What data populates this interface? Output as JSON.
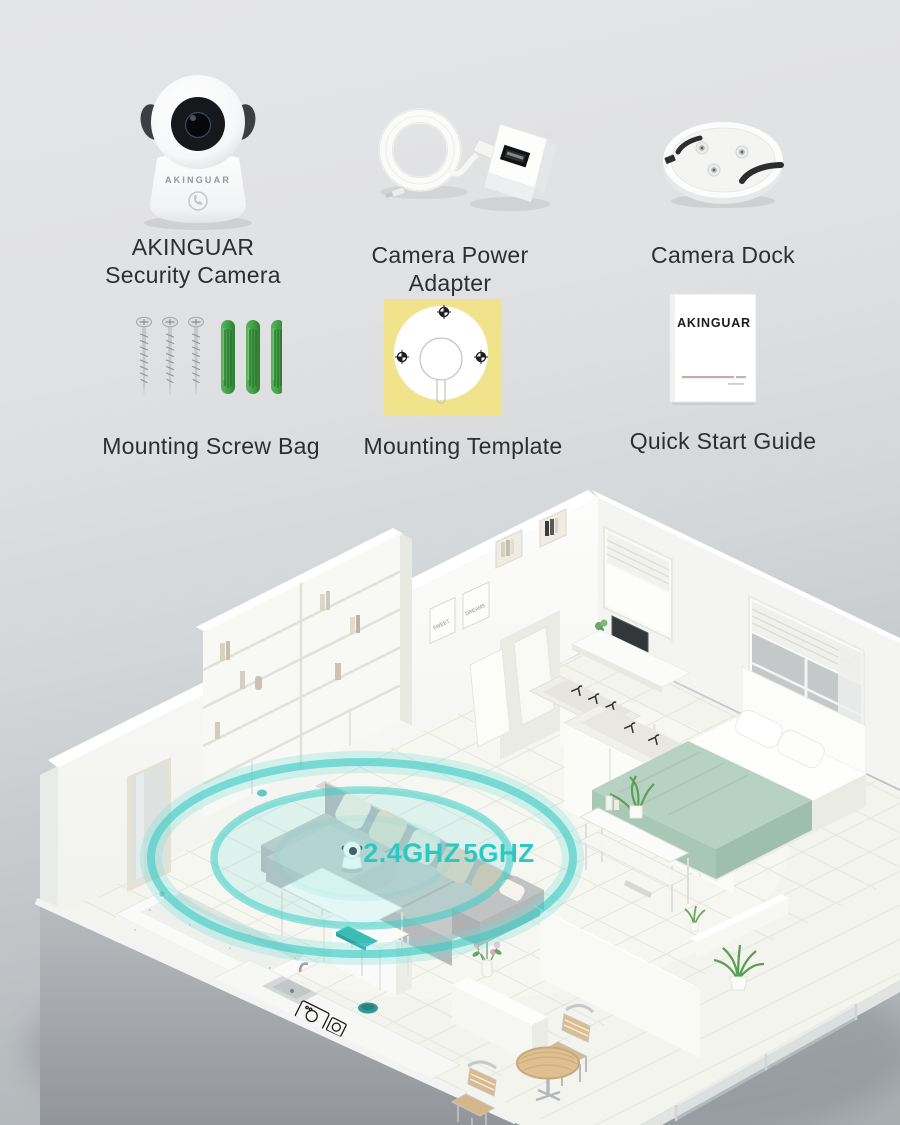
{
  "items": [
    {
      "name": "security-camera",
      "line1": "AKINGUAR",
      "line2": "Security Camera",
      "brand": "AKINGUAR"
    },
    {
      "name": "power-adapter",
      "line1": "Camera Power",
      "line2": "Adapter"
    },
    {
      "name": "camera-dock",
      "line1": "Camera Dock",
      "line2": ""
    },
    {
      "name": "mounting-screw-bag",
      "line1": "Mounting Screw Bag",
      "line2": ""
    },
    {
      "name": "mounting-template",
      "line1": "Mounting Template",
      "line2": ""
    },
    {
      "name": "quick-start-guide",
      "line1": "Quick Start Guide",
      "line2": "",
      "brand": "AKINGUAR"
    }
  ],
  "floorplan": {
    "wifi": {
      "band_24": "2.4GHZ",
      "band_5": "5GHZ"
    },
    "posters": {
      "left": "SWEET",
      "right": "DREAMS"
    }
  },
  "colors": {
    "teal": "#3ecdc7",
    "template_yellow": "#f1e38b",
    "anchor_green": "#3f9e42",
    "sage_blanket": "#b7d2c2",
    "background_top": "#e4e5e7",
    "background_bottom": "#a8adb0"
  }
}
